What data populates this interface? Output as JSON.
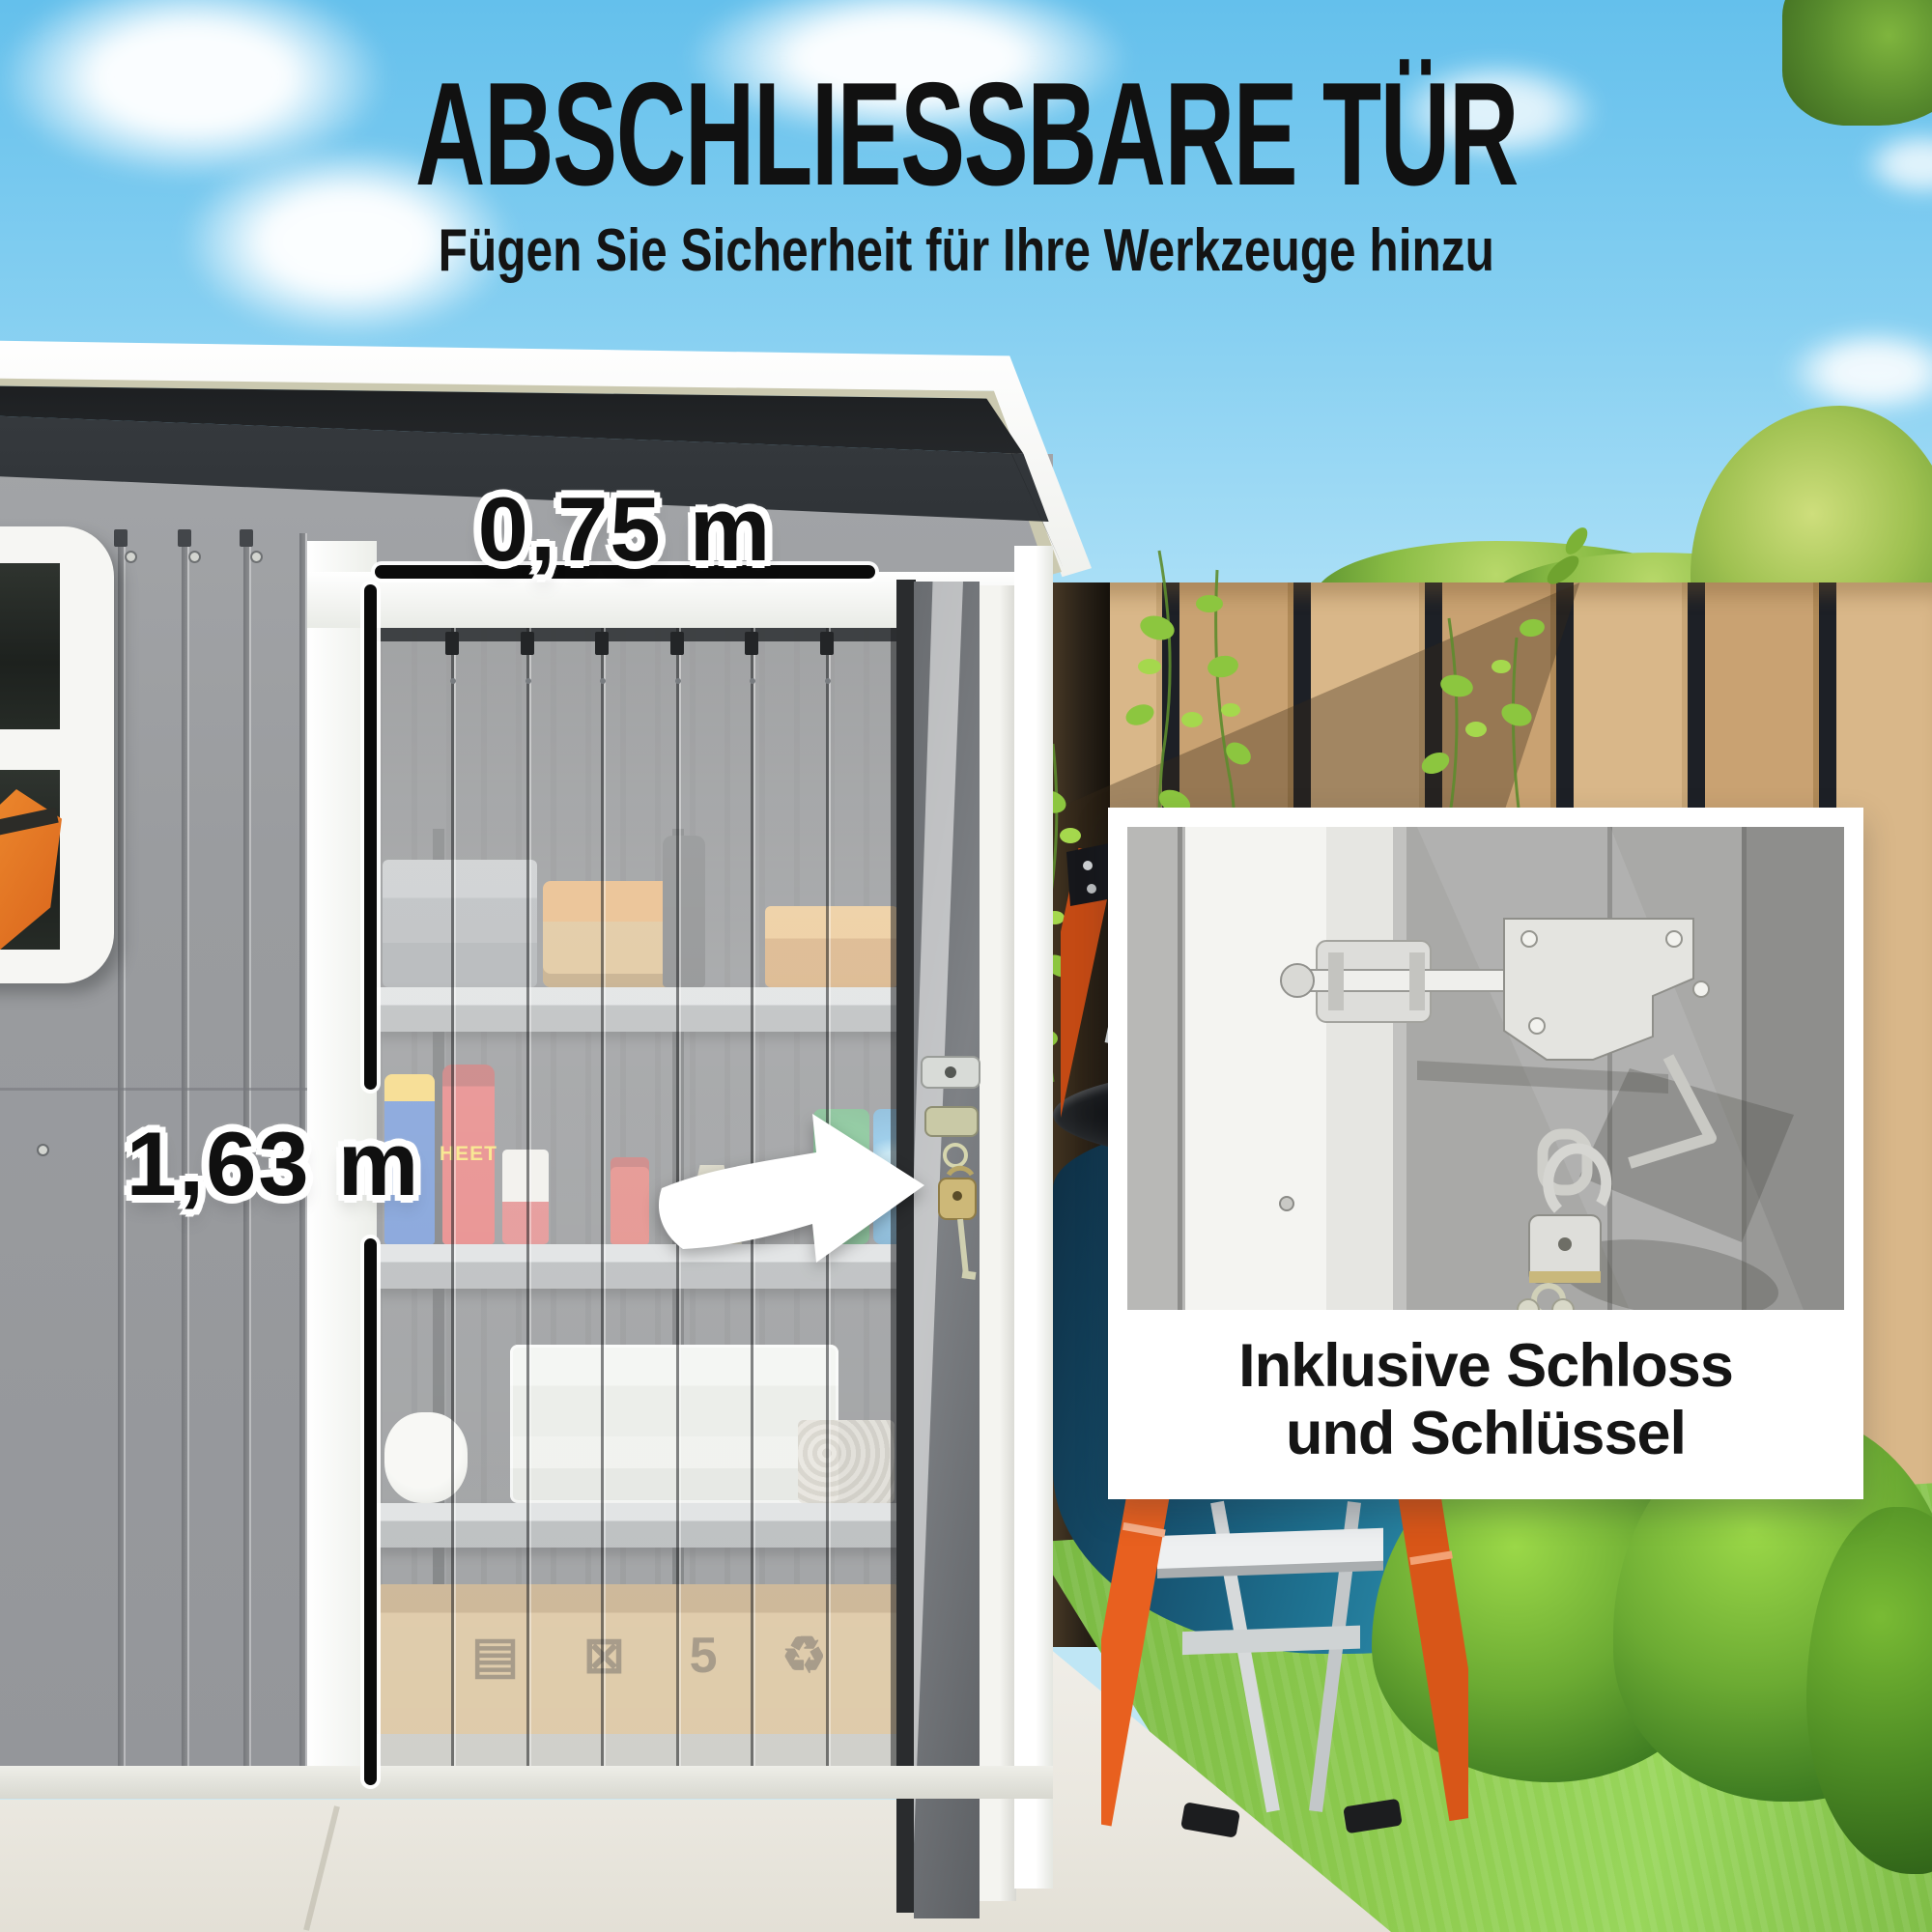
{
  "header": {
    "title": "ABSCHLIESSBARE TÜR",
    "subtitle": "Fügen Sie Sicherheit für Ihre Werkzeuge hinzu"
  },
  "annotations": {
    "door_width_label": "0,75 m",
    "door_height_label": "1,63 m"
  },
  "inset": {
    "caption_line1": "Inklusive Schloss",
    "caption_line2": "und Schlüssel"
  },
  "shed": {
    "bottle_label": "HEET",
    "carton_icons": "▤ ⊠ 5 ♻",
    "carton_print": "471C A0"
  },
  "palette": {
    "sky_top": "#64c0ec",
    "shed_wall": "#97999c",
    "fence_wood": "#c9a272",
    "grass_green": "#8ecb4f",
    "barrel_blue": "#1f7392",
    "ladder_orange": "#e65c1f",
    "text_black": "#111111",
    "accent_white": "#ffffff"
  },
  "icons": {
    "arrow": "door-open-direction-arrow"
  }
}
